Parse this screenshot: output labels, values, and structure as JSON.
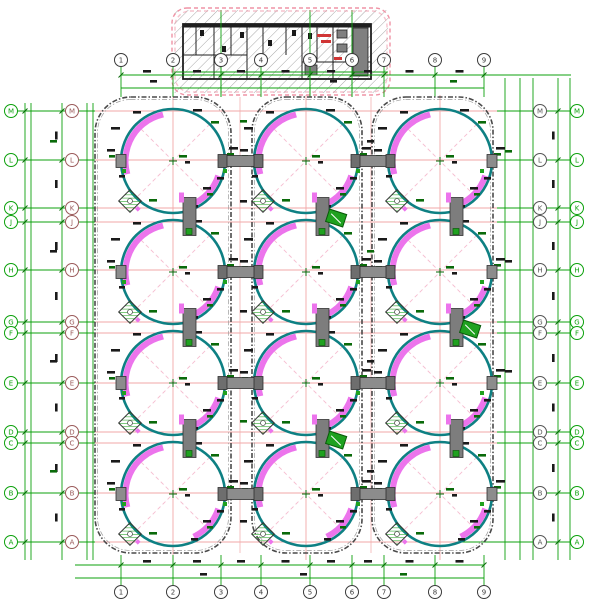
{
  "drawing": {
    "kind": "tank-farm-structural-plan",
    "colors": {
      "teal": "#0e8083",
      "magenta": "#ec74ec",
      "green": "#0ca10c",
      "dark_green": "#0a6a0a",
      "pink_grid": "#f2a7a7",
      "pink_dash": "#f6bdd0",
      "gray_node": "#8c8c8c",
      "gray_node_dark": "#6e6e6e",
      "gray_struct": "#7d7d7d",
      "enclosure_outline": "#4a4a4a",
      "ink": "#1a1a1a",
      "cloud": "#ef93a5",
      "maroon_bubble": "#9a5a5a",
      "right_inner_bubble": "#555555",
      "equip_green": "#1fa11f",
      "hatch": "#a8a8a8",
      "wall": "#1f1f1f",
      "red_label": "#d03535"
    },
    "axes": {
      "top": {
        "y": 60,
        "x": [
          121,
          173,
          221,
          261,
          310,
          352,
          384,
          435,
          484
        ],
        "labels": [
          "1",
          "2",
          "3",
          "4",
          "5",
          "6",
          "7",
          "8",
          "9"
        ]
      },
      "bottom": {
        "y": 592,
        "x": [
          121,
          173,
          221,
          261,
          310,
          352,
          384,
          435,
          484
        ],
        "labels": [
          "1",
          "2",
          "3",
          "4",
          "5",
          "6",
          "7",
          "8",
          "9"
        ]
      },
      "rows": {
        "labels": [
          "M",
          "L",
          "K",
          "J",
          "H",
          "G",
          "F",
          "E",
          "D",
          "C",
          "B",
          "A"
        ],
        "y": [
          111,
          160,
          208,
          222,
          270,
          322,
          333,
          383,
          432,
          443,
          493,
          542
        ],
        "left_outer_x": 11,
        "left_inner_x": 72,
        "right_inner_x": 540,
        "right_outer_x": 577
      }
    },
    "tanks": {
      "col_x": [
        173,
        306,
        440
      ],
      "row_y": [
        161,
        272,
        383,
        494
      ],
      "radius": 52
    },
    "enclosures": [
      {
        "x": 95,
        "y": 97,
        "w": 136,
        "h": 456,
        "rx": 36
      },
      {
        "x": 252,
        "y": 97,
        "w": 110,
        "h": 456,
        "rx": 34
      },
      {
        "x": 372,
        "y": 97,
        "w": 121,
        "h": 456,
        "rx": 34
      }
    ],
    "corridor_bridges_x": [
      [
        219,
        262
      ],
      [
        352,
        394
      ]
    ],
    "inset": {
      "cloud": {
        "x": 172,
        "y": 8,
        "w": 218,
        "h": 87,
        "rx": 15
      },
      "outer_wall": {
        "x": 183,
        "y": 24,
        "w": 188,
        "h": 55
      },
      "partitions_v": [
        [
          196,
          27,
          55
        ],
        [
          214,
          27,
          79
        ],
        [
          231,
          27,
          55
        ],
        [
          247,
          27,
          79
        ],
        [
          263,
          27,
          55
        ],
        [
          286,
          27,
          55
        ],
        [
          302,
          27,
          79
        ],
        [
          317,
          27,
          62
        ],
        [
          333,
          27,
          79
        ],
        [
          352,
          27,
          79
        ]
      ],
      "partitions_h": [
        [
          183,
          247,
          55
        ],
        [
          302,
          371,
          62
        ]
      ],
      "fixtures": [
        [
          200,
          30
        ],
        [
          222,
          46
        ],
        [
          240,
          32
        ],
        [
          268,
          40
        ],
        [
          292,
          30
        ],
        [
          308,
          33
        ]
      ],
      "equipment": [
        [
          353,
          28,
          15,
          48
        ],
        [
          337,
          30,
          10,
          8
        ],
        [
          337,
          44,
          10,
          8
        ],
        [
          305,
          65,
          12,
          10
        ]
      ],
      "red_marks": [
        [
          317,
          34,
          14,
          3
        ],
        [
          321,
          40,
          10,
          3
        ],
        [
          334,
          57,
          8,
          3
        ]
      ],
      "stem_x": [
        221,
        310,
        352
      ]
    }
  }
}
